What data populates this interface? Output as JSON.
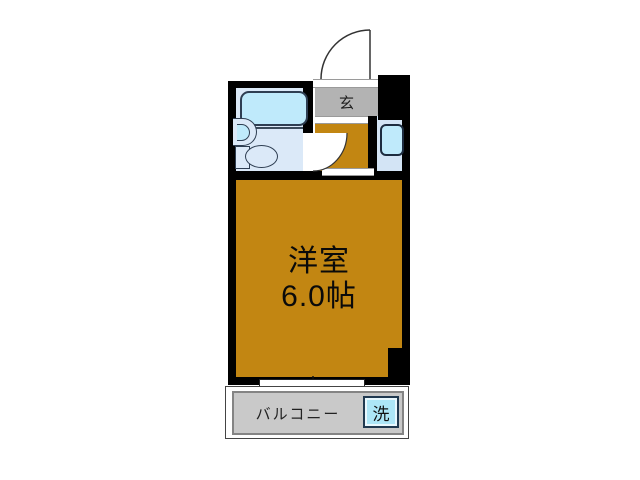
{
  "entrance": {
    "label": "玄"
  },
  "main_room": {
    "name": "洋室",
    "size": "6.0帖"
  },
  "balcony": {
    "label": "バルコニー"
  },
  "washer": {
    "label": "洗"
  },
  "bathroom": {
    "fixtures": [
      "bathtub",
      "wash-basin",
      "toilet"
    ]
  },
  "hallway": {
    "fixtures": [
      "vanity-sink"
    ]
  },
  "colors": {
    "wall": "#000000",
    "room_fill": "#c28612",
    "entrance_fill": "#b3b3b3",
    "balcony_fill": "#c9c9c9",
    "bath_floor": "#dbe9f8",
    "nook_floor": "#d3e4f5",
    "fixture_fill": "#bfeafb",
    "washer_fill": "#ade6f7"
  }
}
